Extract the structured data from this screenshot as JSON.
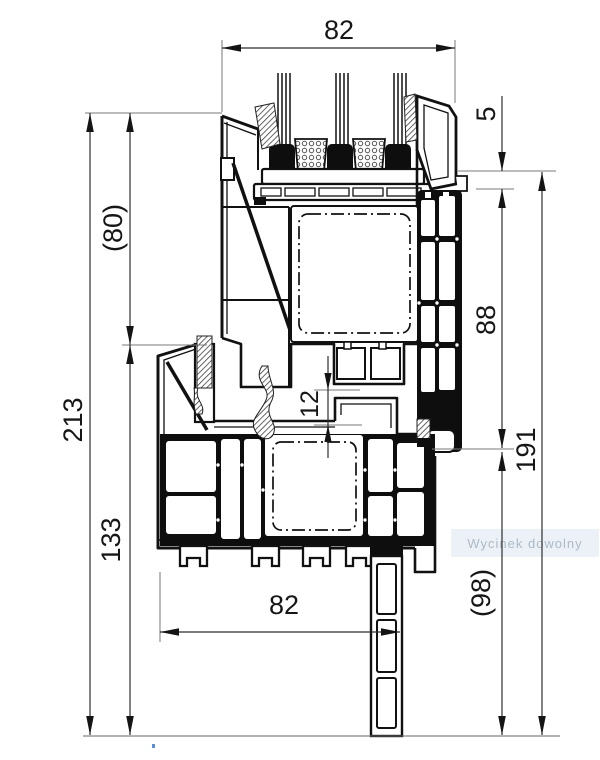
{
  "diagram": {
    "title": "PVC window frame and sash profile cross-section",
    "watermark": "Wycinek dowolny",
    "dims": {
      "top_width": "82",
      "glass_cover": "5",
      "sash_face_height": "88",
      "total_right_height": "191",
      "extension_height": "(98)",
      "sash_height_left": "(80)",
      "total_left_height": "213",
      "frame_height_left": "133",
      "rebate_gap": "12",
      "bottom_width": "82"
    }
  }
}
